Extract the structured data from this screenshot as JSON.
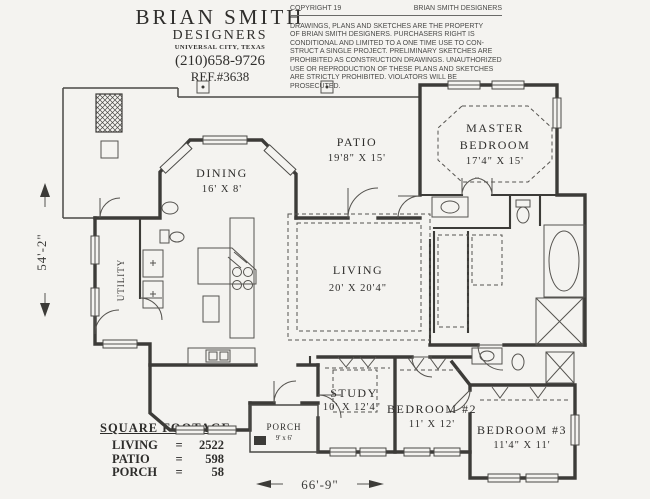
{
  "header": {
    "studio_line1": "BRIAN  SMITH",
    "studio_line2": "DESIGNERS",
    "city": "UNIVERSAL CITY, TEXAS",
    "phone": "(210)658-9726",
    "ref": "REF.#3638"
  },
  "copyright": {
    "left": "COPYRIGHT 19",
    "right": "BRIAN  SMITH DESIGNERS",
    "lines": [
      "DRAWINGS, PLANS AND SKETCHES ARE THE PROPERTY",
      "OF BRIAN SMITH DESIGNERS.  PURCHASERS RIGHT IS",
      "CONDITIONAL AND LIMITED TO A ONE TIME USE TO CON-",
      "STRUCT A SINGLE PROJECT.  PRELIMINARY SKETCHES ARE",
      "PROHIBITED AS CONSTRUCTION DRAWINGS.  UNAUTHORIZED",
      "USE OR REPRODUCTION OF THESE PLANS AND SKETCHES",
      "ARE STRICTLY PROHIBITED.  VIOLATORS WILL BE PROSECUTED."
    ]
  },
  "rooms": {
    "patio": {
      "name": "PATIO",
      "dims": "19'8\" X 15'"
    },
    "master": {
      "name1": "MASTER",
      "name2": "BEDROOM",
      "dims": "17'4\" X 15'"
    },
    "dining": {
      "name": "DINING",
      "dims": "16' X 8'"
    },
    "living": {
      "name": "LIVING",
      "dims": "20' X 20'4\""
    },
    "utility": {
      "name": "UTILITY"
    },
    "study": {
      "name": "STUDY",
      "dims": "10' X 12'4\""
    },
    "bedroom2": {
      "name": "BEDROOM #2",
      "dims": "11' X 12'"
    },
    "bedroom3": {
      "name": "BEDROOM #3",
      "dims": "11'4\" X 11'"
    },
    "porch": {
      "name": "PORCH",
      "dims": "9' x 6'"
    }
  },
  "dimensions": {
    "left": "54'-2\"",
    "bottom": "66'-9\""
  },
  "square_footage": {
    "title": "SQUARE FOOTAGE:",
    "rows": [
      {
        "label": "LIVING",
        "eq": "=",
        "value": "2522"
      },
      {
        "label": "PATIO",
        "eq": "=",
        "value": "598"
      },
      {
        "label": "PORCH",
        "eq": "=",
        "value": "58"
      }
    ]
  }
}
